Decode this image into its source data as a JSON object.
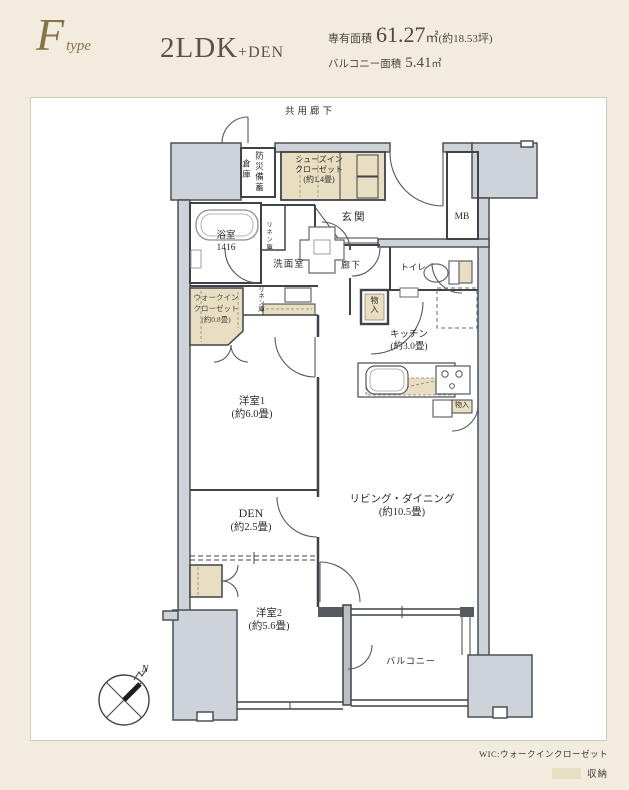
{
  "header": {
    "type_letter": "F",
    "type_suffix": "type",
    "layout_main": "2LDK",
    "layout_sub": "+DEN",
    "area_label": "専有面積",
    "area_value": "61.27",
    "area_unit": "㎡",
    "area_tsubo": "(約18.53坪)",
    "balcony_label": "バルコニー面積",
    "balcony_value": "5.41",
    "balcony_unit": "㎡"
  },
  "plan": {
    "corridor": "共用廊下",
    "rooms": {
      "storage_warehouse": {
        "col1": "防災備蓄",
        "col2": "倉庫"
      },
      "shoes_in_closet": {
        "line1": "シューズイン",
        "line2": "クローゼット",
        "size": "(約1.4畳)"
      },
      "entrance": "玄関",
      "meter_box": "MB",
      "bathroom": {
        "name": "浴室",
        "size": "1416"
      },
      "linen1": "リネン庫",
      "washroom": "洗面室",
      "hallway": "廊下",
      "toilet": "トイレ",
      "storage1": "物入",
      "walk_in_closet": {
        "line1": "ウォークイン",
        "line2": "クローゼット",
        "size": "(約0.8畳)"
      },
      "linen2": "リネン庫",
      "kitchen": {
        "name": "キッチン",
        "size": "(約3.0畳)"
      },
      "storage2": "物入",
      "bedroom1": {
        "name": "洋室1",
        "size": "(約6.0畳)"
      },
      "living_dining": {
        "name": "リビング・ダイニング",
        "size": "(約10.5畳)"
      },
      "den": {
        "name": "DEN",
        "size": "(約2.5畳)"
      },
      "bedroom2": {
        "name": "洋室2",
        "size": "(約5.6畳)"
      },
      "balcony": "バルコニー"
    },
    "compass_n": "N"
  },
  "legend": {
    "wic_note": "WIC:ウォークインクローゼット",
    "storage_label": "収納"
  },
  "colors": {
    "page_bg": "#f1ecdd",
    "panel_bg": "#ffffff",
    "concrete_fill": "#cdd3d8",
    "wall_stroke": "#3f4347",
    "storage_fill": "#e8dec2",
    "accent_brown": "#8a7246",
    "text_dark": "#2e2c29"
  }
}
